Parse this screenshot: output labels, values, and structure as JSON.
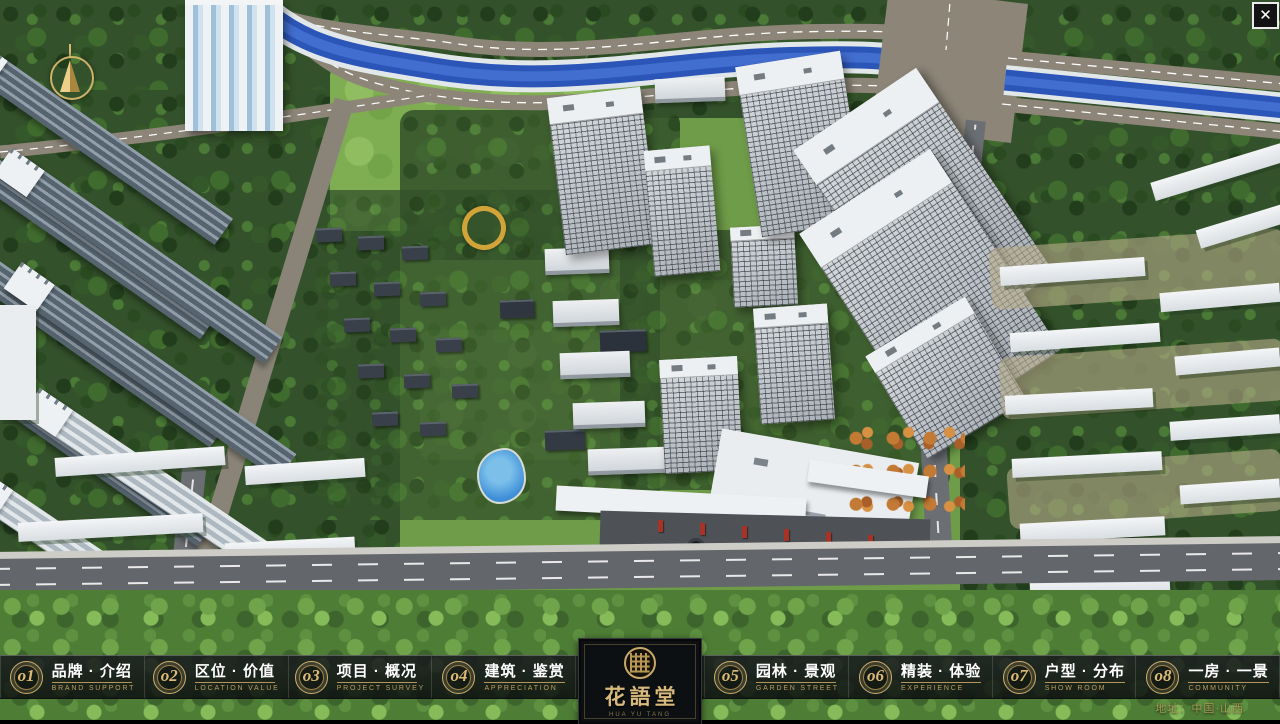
{
  "window": {
    "close_label": "✕"
  },
  "logo": {
    "name": "花語堂",
    "subtitle": "HUA YU TANG"
  },
  "footer": {
    "address": "地址：中国·山西"
  },
  "nav": {
    "items": [
      {
        "num": "o1",
        "zh": "品牌 · 介绍",
        "en": "BRAND SUPPORT"
      },
      {
        "num": "o2",
        "zh": "区位 · 价值",
        "en": "LOCATION VALUE"
      },
      {
        "num": "o3",
        "zh": "项目 · 概况",
        "en": "PROJECT SURVEY"
      },
      {
        "num": "o4",
        "zh": "建筑 · 鉴赏",
        "en": "APPRECIATION"
      },
      {
        "num": "o5",
        "zh": "园林 · 景观",
        "en": "GARDEN STREET"
      },
      {
        "num": "o6",
        "zh": "精装 · 体验",
        "en": "EXPERIENCE"
      },
      {
        "num": "o7",
        "zh": "户型 · 分布",
        "en": "SHOW ROOM"
      },
      {
        "num": "o8",
        "zh": "一房 · 一景",
        "en": "COMMUNITY"
      }
    ]
  }
}
